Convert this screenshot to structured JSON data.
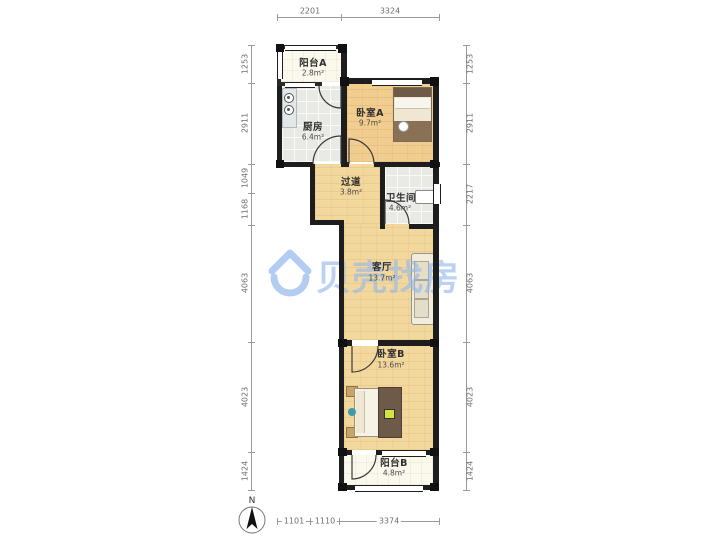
{
  "watermark": {
    "brand": "贝壳找房"
  },
  "compass": {
    "label": "N"
  },
  "rooms": [
    {
      "id": "balcony-a",
      "name": "阳台A",
      "area": "2.8m²"
    },
    {
      "id": "kitchen",
      "name": "厨房",
      "area": "6.4m²"
    },
    {
      "id": "bedroom-a",
      "name": "卧室A",
      "area": "9.7m²"
    },
    {
      "id": "hallway",
      "name": "过道",
      "area": "3.8m²"
    },
    {
      "id": "bathroom",
      "name": "卫生间",
      "area": "4.6m²"
    },
    {
      "id": "living-room",
      "name": "客厅",
      "area": "13.7m²"
    },
    {
      "id": "bedroom-b",
      "name": "卧室B",
      "area": "13.6m²"
    },
    {
      "id": "balcony-b",
      "name": "阳台B",
      "area": "4.8m²"
    }
  ],
  "dimensions": {
    "top": [
      {
        "value": "2201"
      },
      {
        "value": "3324"
      }
    ],
    "bottom": [
      {
        "value": "1101"
      },
      {
        "value": "1110"
      },
      {
        "value": "3374"
      }
    ],
    "left": [
      {
        "value": "1253"
      },
      {
        "value": "2911"
      },
      {
        "value": "1049"
      },
      {
        "value": "1168"
      },
      {
        "value": "4063"
      },
      {
        "value": "4023"
      },
      {
        "value": "1424"
      }
    ],
    "right": [
      {
        "value": "1253"
      },
      {
        "value": "2911"
      },
      {
        "value": "2217"
      },
      {
        "value": "4063"
      },
      {
        "value": "4023"
      },
      {
        "value": "1424"
      }
    ]
  },
  "colors": {
    "wall": "#1d1d1d",
    "wood_floor": "#F3D89E",
    "tile_floor": "#E9E9E6",
    "balcony_floor": "#FBF8EC",
    "watermark_blue": "#A6C4F0"
  }
}
